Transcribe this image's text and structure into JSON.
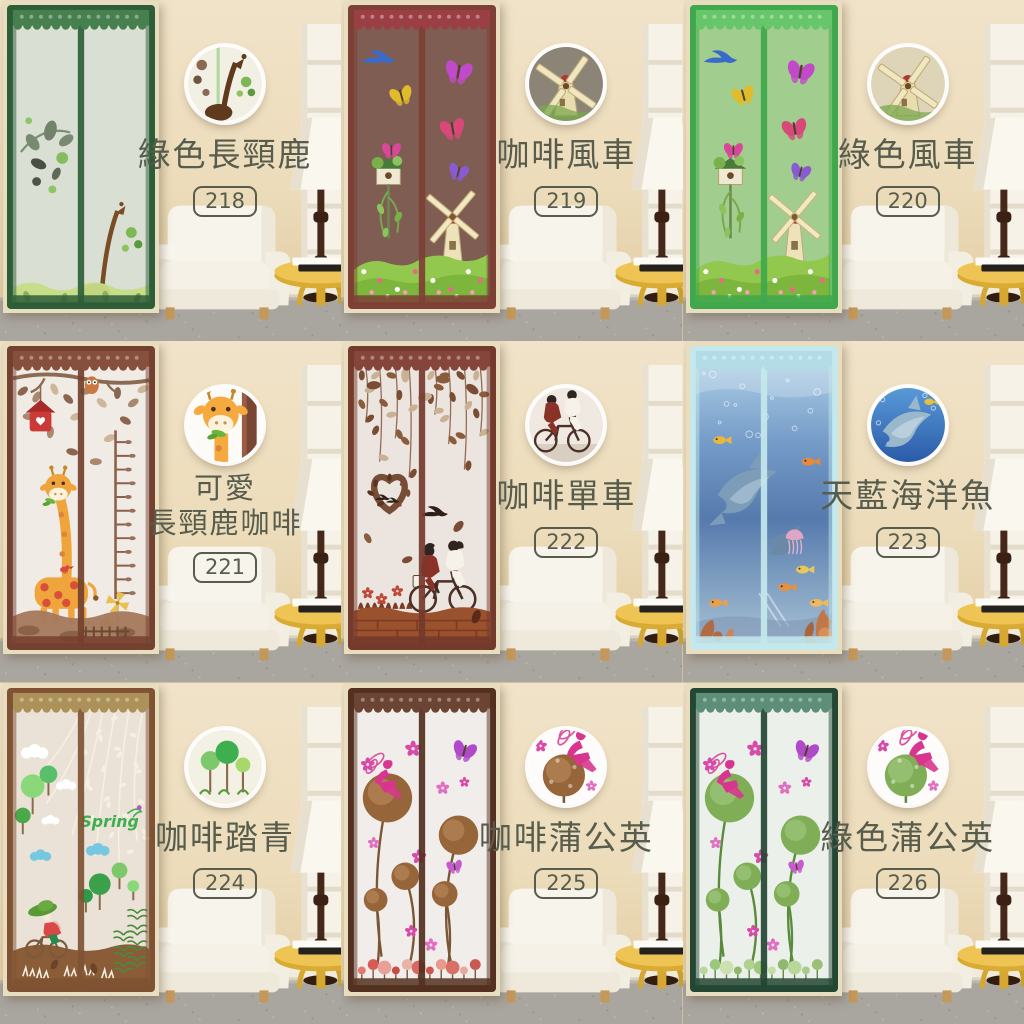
{
  "page": {
    "description": "3x3 product catalog collage of magnetic screen door curtains shown in a living room",
    "grid": {
      "rows": 3,
      "cols": 3
    }
  },
  "label_style": {
    "text_color": "#575c4d"
  },
  "room": {
    "wall_color": "#ecdcba",
    "carpet_color": "#a9a59f",
    "furniture": [
      "white-armchair",
      "yellow-round-side-table",
      "floor-lamp",
      "white-shelf",
      "books-on-table"
    ]
  },
  "products": [
    {
      "code": "218",
      "name_lines": [
        "綠色長頸鹿"
      ],
      "badge_icon": "giraffe-silhouette-icon",
      "theme": "green_giraffe",
      "frame_color": "#2e5e38",
      "lace_color": "#47804f",
      "mesh_fill": "rgba(248,246,238,0.85)"
    },
    {
      "code": "219",
      "name_lines": [
        "咖啡風車"
      ],
      "badge_icon": "windmill-icon",
      "theme": "windmill",
      "frame_color": "#7e3f35",
      "lace_color": "#9c3f45",
      "mesh_fill": "rgba(128,118,108,0.55)",
      "badge_bg": "#8d8478"
    },
    {
      "code": "220",
      "name_lines": [
        "綠色風車"
      ],
      "badge_icon": "windmill-icon",
      "theme": "windmill",
      "frame_color": "#3fa84c",
      "lace_color": "#67c56a",
      "mesh_fill": "rgba(243,236,198,0.55)",
      "badge_bg": "#ded5b8"
    },
    {
      "code": "221",
      "name_lines": [
        "可愛",
        "長頸鹿咖啡"
      ],
      "badge_icon": "cartoon-giraffe-icon",
      "theme": "cute_giraffe",
      "frame_color": "#74402f",
      "lace_color": "#86503c",
      "mesh_fill": "rgba(252,250,246,0.92)"
    },
    {
      "code": "222",
      "name_lines": [
        "咖啡單車"
      ],
      "badge_icon": "bicycle-couple-icon",
      "theme": "bicycle",
      "frame_color": "#743a2c",
      "lace_color": "#85453a",
      "mesh_fill": "rgba(250,247,242,0.90)"
    },
    {
      "code": "223",
      "name_lines": [
        "天藍海洋魚"
      ],
      "badge_icon": "dolphin-icon",
      "theme": "ocean",
      "frame_color": "#c4e8ec",
      "lace_color": "#b2dde6",
      "mesh_fill": "gradient-ocean"
    },
    {
      "code": "224",
      "name_lines": [
        "咖啡踏青"
      ],
      "badge_icon": "trees-icon",
      "theme": "spring",
      "frame_color": "#7e5233",
      "lace_color": "#ac9258",
      "mesh_fill": "rgba(250,246,238,0.88)",
      "curtain_text": "Spring"
    },
    {
      "code": "225",
      "name_lines": [
        "咖啡蒲公英"
      ],
      "badge_icon": "dandelion-fairy-icon",
      "theme": "dandelion",
      "frame_color": "#53301f",
      "lace_color": "#6b4434",
      "mesh_fill": "rgba(253,252,250,0.93)",
      "ball_color": "#96653a",
      "ball_color2": "#b8895a",
      "stem_color": "#7a5634",
      "fairy_color": "#d8368e",
      "ground_dots": [
        "#e07a70",
        "#d85a54",
        "#e8a098",
        "#c84c46",
        "#e8b4a8",
        "#d86860",
        "#c85850",
        "#e8988c",
        "#d87068",
        "#e8a89c",
        "#c85a50"
      ]
    },
    {
      "code": "226",
      "name_lines": [
        "綠色蒲公英"
      ],
      "badge_icon": "dandelion-fairy-icon",
      "theme": "dandelion",
      "frame_color": "#234733",
      "lace_color": "#5d8f78",
      "mesh_fill": "rgba(252,253,250,0.93)",
      "ball_color": "#7fae57",
      "ball_color2": "#a2c87e",
      "stem_color": "#5a8a3c",
      "fairy_color": "#d8368e",
      "ground_dots": [
        "#b8d89a",
        "#9ac87e",
        "#cce0b0",
        "#8fb868",
        "#b0d090",
        "#a0c87e",
        "#c4dca6",
        "#90b870",
        "#b8d89a",
        "#a8cc88",
        "#9cc078"
      ]
    }
  ]
}
